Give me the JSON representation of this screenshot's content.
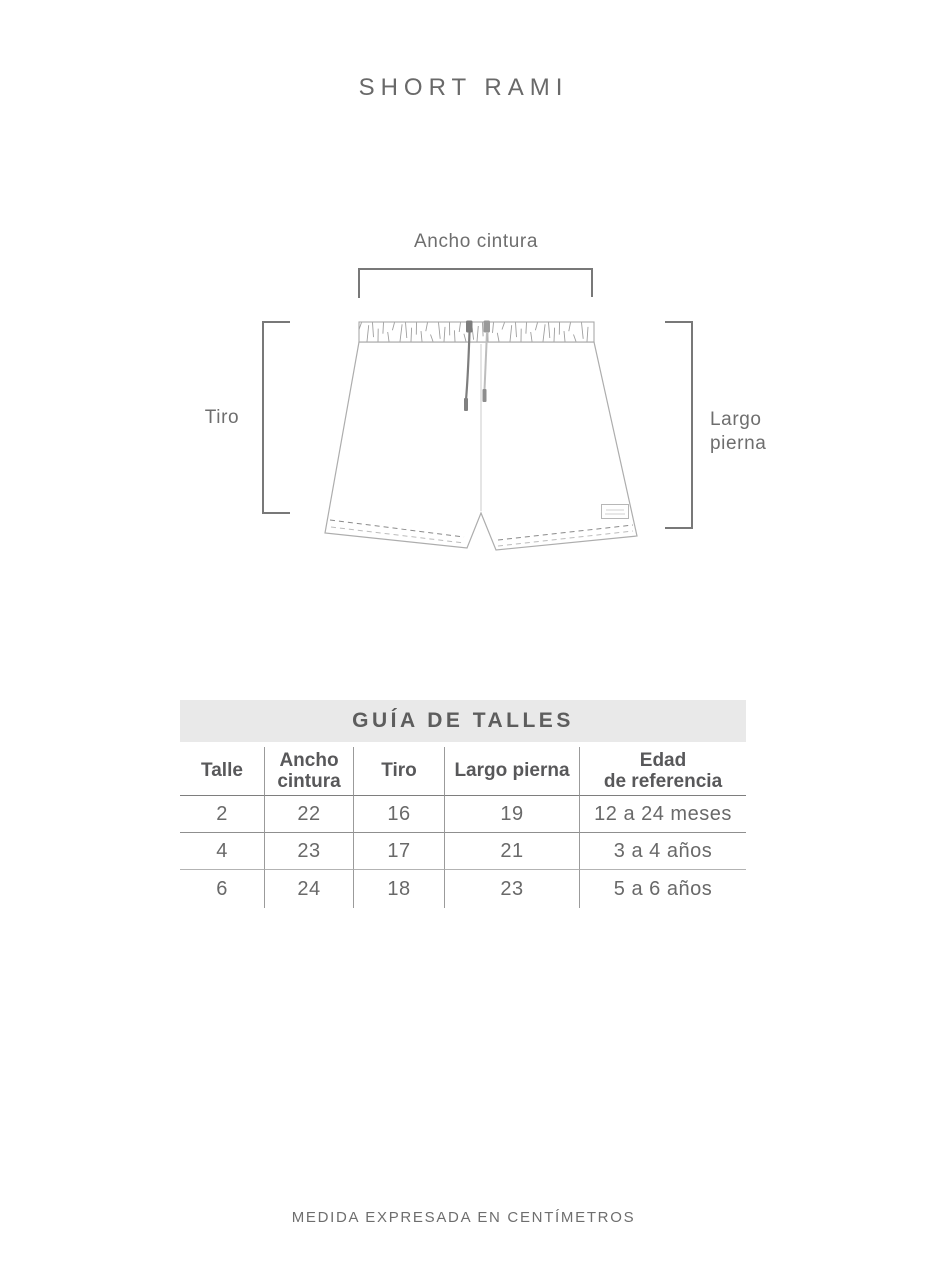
{
  "title": "SHORT RAMI",
  "diagram": {
    "waist_label": "Ancho cintura",
    "rise_label": "Tiro",
    "leg_label": "Largo pierna"
  },
  "size_guide": {
    "title": "GUÍA DE TALLES",
    "columns": [
      "Talle",
      "Ancho\ncintura",
      "Tiro",
      "Largo pierna",
      "Edad\nde referencia"
    ],
    "rows": [
      [
        "2",
        "22",
        "16",
        "19",
        "12 a 24 meses"
      ],
      [
        "4",
        "23",
        "17",
        "21",
        "3 a 4 años"
      ],
      [
        "6",
        "24",
        "18",
        "23",
        "5 a 6 años"
      ]
    ]
  },
  "footer": "MEDIDA EXPRESADA EN CENTÍMETROS",
  "colors": {
    "band_bg": "#e9e9e9",
    "text": "#6e6e6e",
    "bracket": "#787878",
    "shorts_outline": "#adadad",
    "header_rule": "#7e7e7e"
  }
}
